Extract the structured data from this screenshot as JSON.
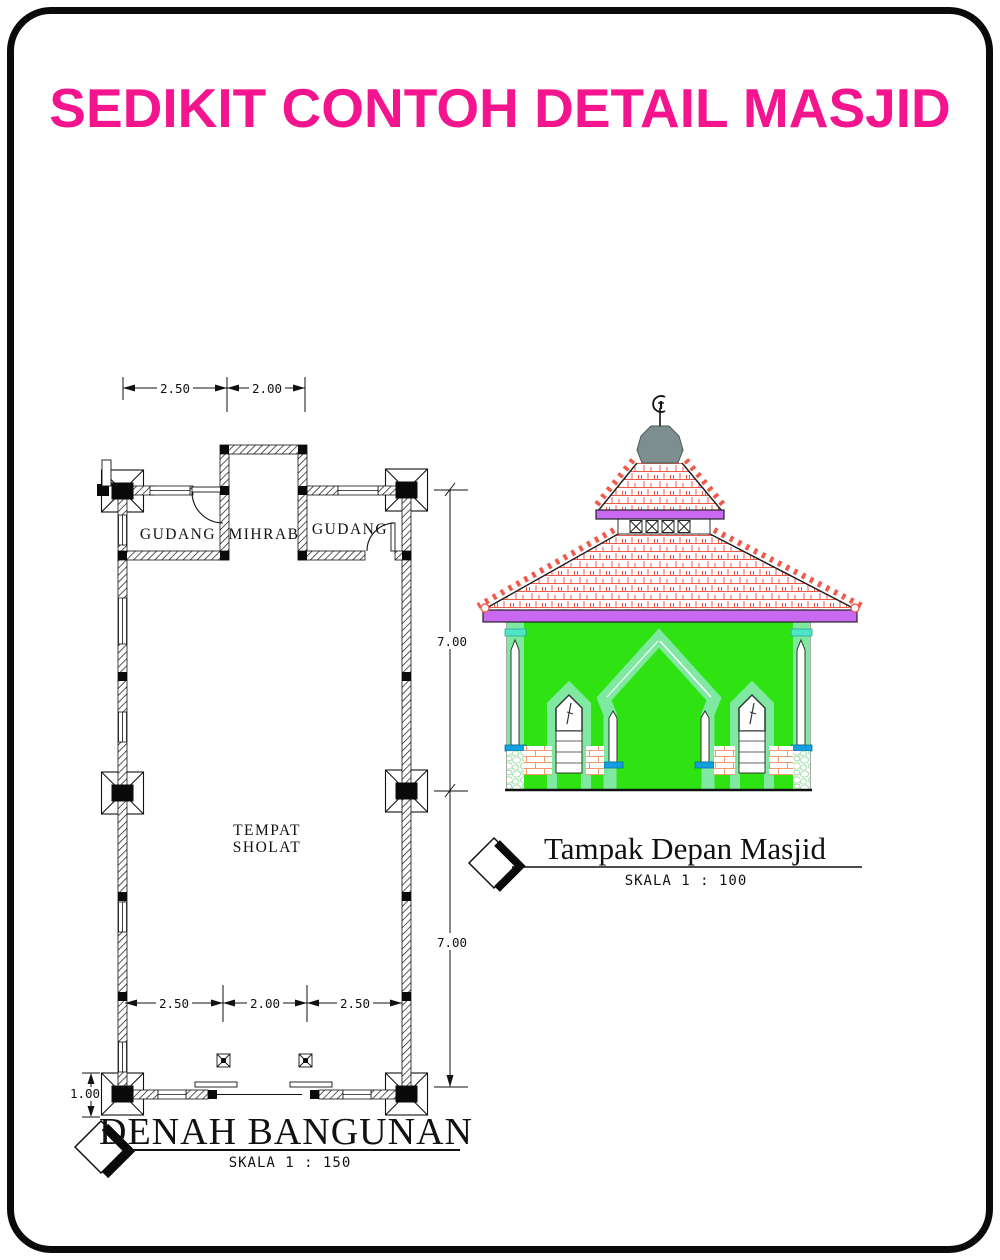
{
  "page": {
    "title": "SEDIKIT CONTOH DETAIL MASJID",
    "title_color": "#F3148E"
  },
  "floor_plan": {
    "title": "DENAH BANGUNAN",
    "scale": "SKALA  1 : 150",
    "labels": {
      "gudang_left": "GUDANG",
      "mihrab": "MIHRAB",
      "gudang_right": "GUDANG",
      "prayer_room_line1": "TEMPAT",
      "prayer_room_line2": "SHOLAT"
    },
    "dims": {
      "top_span_left": "2.50",
      "top_span_right": "2.00",
      "right_span_upper": "7.00",
      "right_span_lower": "7.00",
      "inner_span_left": "2.50",
      "inner_span_mid": "2.00",
      "inner_span_right": "2.50",
      "porch_depth": "1.00"
    }
  },
  "elevation": {
    "title": "Tampak Depan Masjid",
    "scale": "SKALA  1 : 100",
    "colors": {
      "wall": "#2fe312",
      "trim": "#7fe9a1",
      "roof_tile": "#EF5B4B",
      "fascia": "#c969f2",
      "accent_cyan": "#4fe6c6",
      "accent_blue": "#129fe0",
      "brick": "#f09a6e",
      "dome": "#7c8e8e"
    }
  }
}
